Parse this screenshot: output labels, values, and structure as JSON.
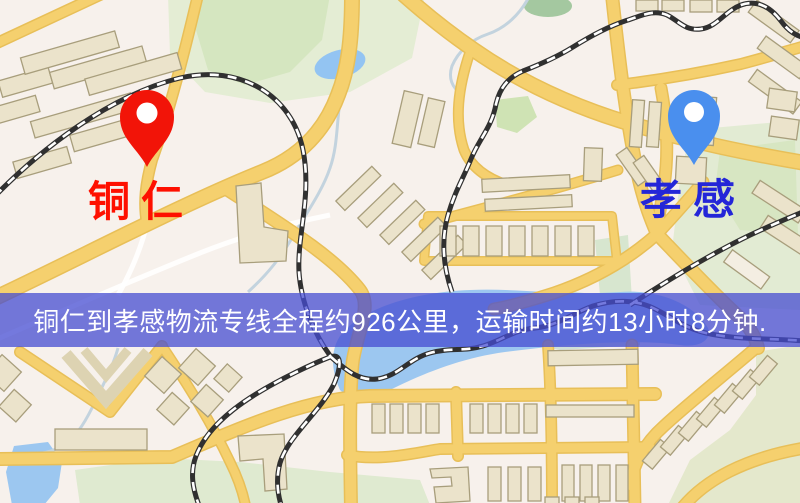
{
  "banner": {
    "text": "铜仁到孝感物流专线全程约926公里，运输时间约13小时8分钟.",
    "background": "rgba(70, 76, 210, 0.75)",
    "text_color": "#ffffff"
  },
  "origin": {
    "name": "铜仁",
    "pin_color": "#f21408",
    "label_color": "#fe1000"
  },
  "destination": {
    "name": "孝感",
    "pin_color": "#4a8fee",
    "label_color": "#2426d8"
  },
  "map_palette": {
    "background": "#f7f1ec",
    "road": "#f5d06e",
    "minor_road": "#ffffff",
    "building_fill": "#ebe3cb",
    "building_outline": "#a89e7c",
    "park": "#d9e7c4",
    "water": "#9cc7f0",
    "railway_dark": "#303030"
  }
}
